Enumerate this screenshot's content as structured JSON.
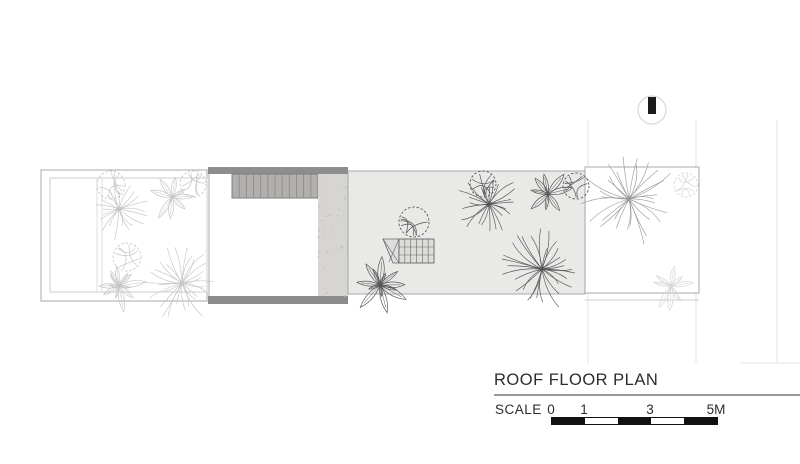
{
  "title_block": {
    "title": "ROOF FLOOR PLAN",
    "scale_label": "SCALE",
    "scale_ticks": [
      "0",
      "1",
      "3",
      "5M"
    ],
    "scale_bar": {
      "x": 551,
      "y": 417,
      "width": 165,
      "height": 6,
      "segments": 5,
      "tick_fractions": [
        0,
        0.2,
        0.6,
        1.0
      ]
    }
  },
  "north_indicator": {
    "cx": 652,
    "cy": 110,
    "r": 14,
    "bar_w": 8,
    "bar_h": 17
  },
  "colors": {
    "band": "#8d8d8d",
    "deck_fill": "#b2b0ae",
    "deck_line": "#8a8886",
    "deck_border": "#7f7d7b",
    "concrete": "#d7d5d1",
    "concrete_speck": "#c3c1bd",
    "slab": "#e9e9e7",
    "slab_border": "#9f9f9f",
    "border": "#a8a8a8",
    "border_light": "#cdcdcd",
    "divider": "#dcdcdc",
    "ext_line": "#e3e3e3",
    "skylight_fill": "#dddddb",
    "skylight_line": "#666666",
    "plant_light": "#c6c6c6",
    "plant_light2": "#d5d5d5",
    "plant_mid": "#9b9b9b",
    "plant_dark": "#565656",
    "north_circle": "#d2d2d2",
    "north_bar": "#1a1a1a",
    "text": "#2d2d2d",
    "bar_black": "#111111",
    "bar_white": "#ffffff"
  },
  "plan": {
    "left_garden": {
      "x": 41,
      "y": 170,
      "w": 166,
      "h": 131,
      "inner": {
        "x": 50,
        "y": 178,
        "w": 157,
        "h": 114
      },
      "divider_xs": [
        97,
        102
      ]
    },
    "building": {
      "x": 208,
      "w": 140,
      "top_band": {
        "y": 167,
        "h": 7
      },
      "bottom_band": {
        "y": 296,
        "h": 8
      },
      "wall_x": 209,
      "deck": {
        "x": 232,
        "y": 174,
        "w": 86,
        "h": 24,
        "planks": 12
      },
      "concrete": {
        "x": 318,
        "y": 174,
        "w": 30,
        "h": 122
      }
    },
    "slab": {
      "x": 348,
      "y": 171,
      "w": 237,
      "h": 123
    },
    "right_garden": {
      "x": 585,
      "y": 167,
      "w": 114,
      "h": 126,
      "outer_bottom_y": 300
    },
    "extension_lines": {
      "vxs": [
        588,
        696,
        777
      ],
      "y1": 120,
      "y2": 363,
      "h_line": {
        "x1": 740,
        "x2": 800,
        "y": 363
      }
    },
    "skylight": {
      "grid": {
        "x": 399,
        "y": 239,
        "w": 35,
        "h": 24,
        "cols": 6,
        "rows": 3
      },
      "wedge": {
        "points": [
          [
            383,
            239
          ],
          [
            399,
            239
          ],
          [
            399,
            263
          ],
          [
            393,
            263
          ]
        ],
        "diagonals": [
          [
            [
              383,
              239
            ],
            [
              399,
              263
            ]
          ],
          [
            [
              399,
              239
            ],
            [
              389,
              262
            ]
          ]
        ]
      }
    },
    "plants": [
      {
        "type": "tree",
        "x": 111,
        "y": 185,
        "r": 14,
        "c": "light"
      },
      {
        "type": "palm",
        "x": 119,
        "y": 209,
        "r": 31,
        "c": "light"
      },
      {
        "type": "shrub",
        "x": 172,
        "y": 197,
        "r": 26,
        "c": "light"
      },
      {
        "type": "tree",
        "x": 193,
        "y": 184,
        "r": 13,
        "c": "light"
      },
      {
        "type": "tree",
        "x": 127,
        "y": 257,
        "r": 14,
        "c": "light"
      },
      {
        "type": "shrub",
        "x": 119,
        "y": 286,
        "r": 30,
        "c": "light"
      },
      {
        "type": "palm",
        "x": 182,
        "y": 283,
        "r": 40,
        "c": "light"
      },
      {
        "type": "tree",
        "x": 686,
        "y": 185,
        "r": 12,
        "c": "light2"
      },
      {
        "type": "shrub",
        "x": 671,
        "y": 286,
        "r": 25,
        "c": "light2"
      },
      {
        "type": "palm",
        "x": 629,
        "y": 199,
        "r": 49,
        "c": "mid"
      },
      {
        "type": "tree",
        "x": 414,
        "y": 222,
        "r": 15,
        "c": "dark"
      },
      {
        "type": "shrub",
        "x": 380,
        "y": 285,
        "r": 34,
        "c": "dark"
      },
      {
        "type": "tree",
        "x": 483,
        "y": 184,
        "r": 13,
        "c": "dark"
      },
      {
        "type": "palm",
        "x": 489,
        "y": 204,
        "r": 33,
        "c": "dark"
      },
      {
        "type": "shrub",
        "x": 548,
        "y": 194,
        "r": 28,
        "c": "dark"
      },
      {
        "type": "tree",
        "x": 576,
        "y": 186,
        "r": 13,
        "c": "dark"
      },
      {
        "type": "palm",
        "x": 542,
        "y": 269,
        "r": 42,
        "c": "dark"
      }
    ]
  }
}
